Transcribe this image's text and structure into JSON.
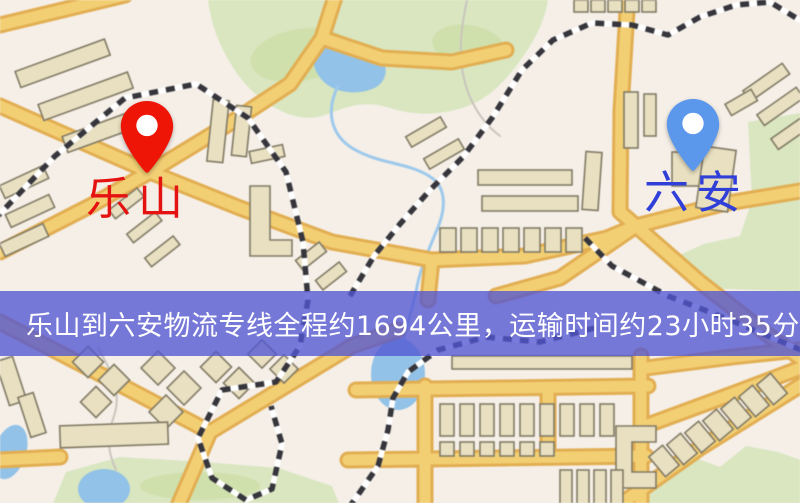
{
  "banner": {
    "text": "乐山到六安物流专线全程约1694公里，运输时间约23小时35分钟.",
    "background": "#5256d2",
    "text_color": "#ffffff"
  },
  "markers": {
    "origin": {
      "label": "乐山",
      "pin_color": "#ee1507",
      "label_color": "#e51212"
    },
    "destination": {
      "label": "六安",
      "pin_color": "#5b97ea",
      "label_color": "#2f3fd8"
    }
  },
  "colors": {
    "bg": "#f5efe8",
    "park": "#d9e6c0",
    "park_dark": "#cbdda6",
    "water": "#92c2e8",
    "road_fill": "#f3cf74",
    "road_casing": "#e2ae52",
    "rail_dark": "#35353b",
    "rail_light": "#ffffff",
    "building_fill": "#e9e0c2",
    "building_stroke": "#817a64",
    "stream": "#9ec9ec",
    "path_grey": "#c9c5bd"
  }
}
